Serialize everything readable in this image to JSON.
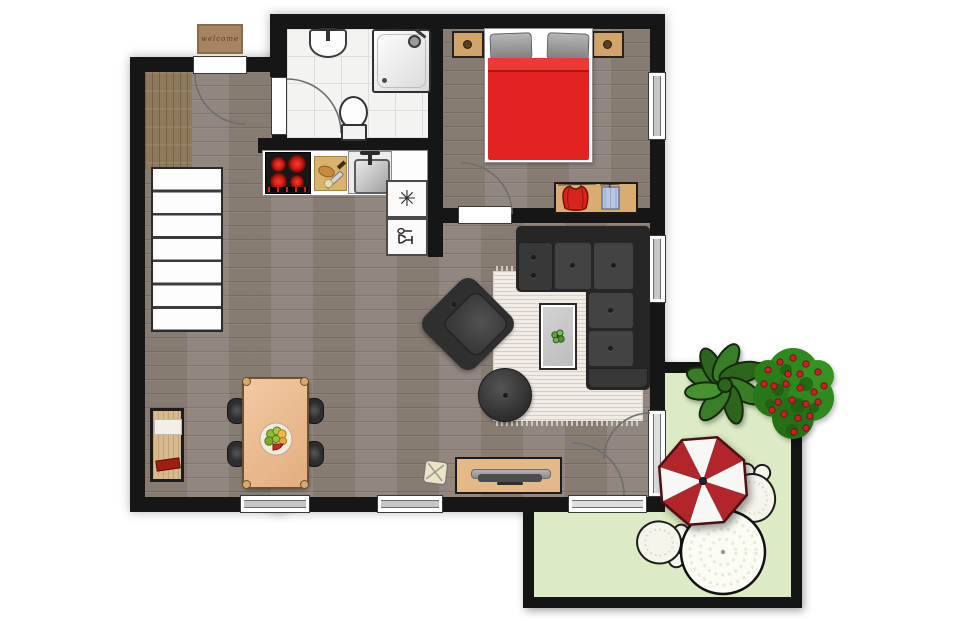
{
  "title": "apartment-floor-plan-with-patio",
  "doormat": {
    "text": "welcome"
  },
  "kitchen": {
    "freezer_glyph": "✳"
  },
  "palette": {
    "wall": "#161616",
    "floor_wood": "#8b8178",
    "entry_wood": "#8e7a5a",
    "bathroom_tile": "#f3f3f1",
    "bed_blanket": "#e32222",
    "pillow_gray": "#9a9a9a",
    "sofa_gray": "#3a3a3a",
    "wood_furniture": "#ddae74",
    "dining_table": "#eec39a",
    "rug": "#f0ebe4",
    "patio_green": "#dcebc3",
    "umbrella_red": "#b2262b",
    "umbrella_white": "#f7f7f5",
    "plant_green": "#3a7d27",
    "flower_red": "#c81f28",
    "wicker_white": "#f8f7ef"
  },
  "rooms": [
    {
      "id": "entrance-hall"
    },
    {
      "id": "bathroom"
    },
    {
      "id": "bedroom"
    },
    {
      "id": "kitchen"
    },
    {
      "id": "living-dining-room"
    },
    {
      "id": "patio"
    }
  ],
  "inventory": {
    "bathroom": [
      "washbasin",
      "shower",
      "toilet"
    ],
    "bedroom": [
      "double-bed",
      "nightstand-left",
      "nightstand-right",
      "wardrobe-with-clothes"
    ],
    "kitchen": [
      "stove-4-burners",
      "cutting-board",
      "sink",
      "freezer",
      "dishwasher"
    ],
    "living": [
      "corner-sofa",
      "armchair",
      "coffee-table",
      "ottoman",
      "rug",
      "tv-sideboard",
      "pouf"
    ],
    "dining": [
      "table-for-four",
      "chairs-x4",
      "fruit-plate",
      "hall-closet"
    ],
    "hall": [
      "staircase",
      "doormat"
    ],
    "patio": [
      "parasol",
      "wicker-table",
      "wicker-chair-x2",
      "green-plant",
      "flowering-bush"
    ]
  }
}
